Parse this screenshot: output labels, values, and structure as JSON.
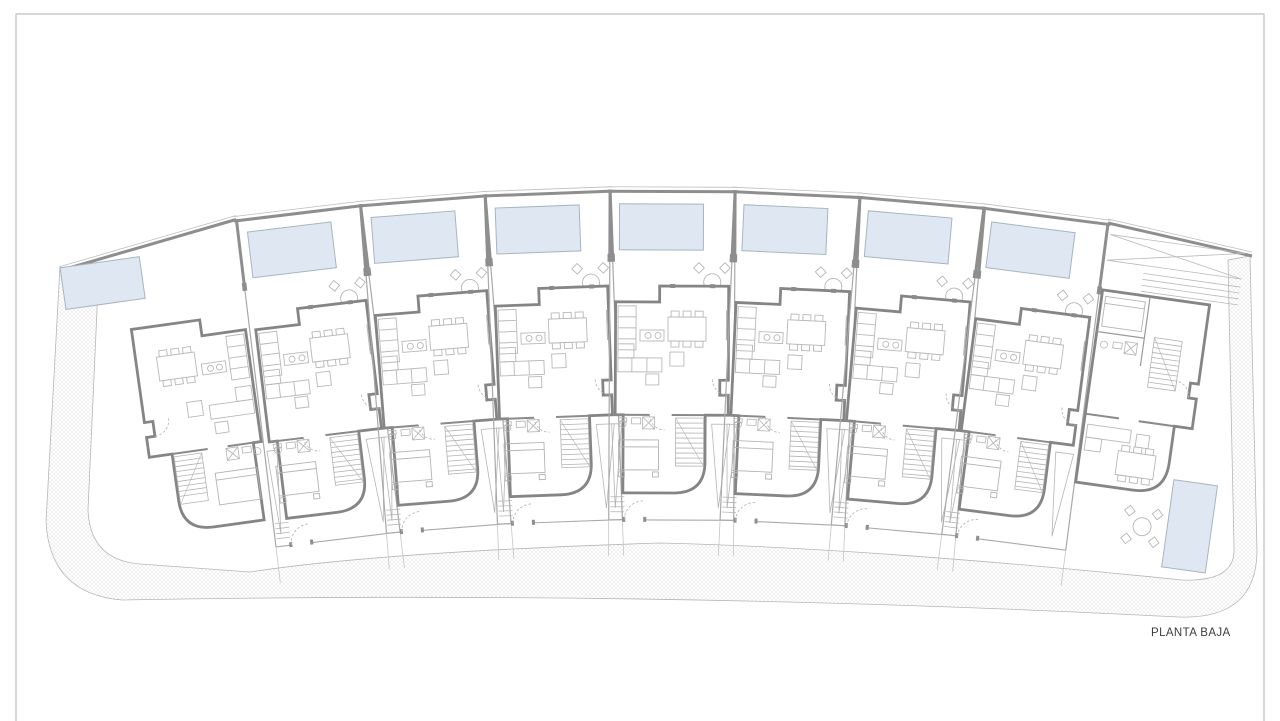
{
  "plan": {
    "title": "PLANTA BAJA",
    "type": "residential-site-plan-ground-floor",
    "units_total": 9,
    "standard_units": 7
  },
  "colors": {
    "paper": "#ffffff",
    "frame": "#bdbdbd",
    "boundary": "#b6b6b6",
    "wall_dark": "#858585",
    "wall_mid": "#9a9a9a",
    "line_light": "#b8b8b8",
    "hatch": "#dedede",
    "pool_fill": "#dfe8f2",
    "pool_border": "#a8b4c2",
    "label": "#3d3d3d"
  },
  "arc": {
    "cx": 660,
    "cy": 3200
  },
  "units": [
    {
      "id": "unit-1",
      "kind": "end-left"
    },
    {
      "id": "unit-2",
      "kind": "standard",
      "angle": -6.9
    },
    {
      "id": "unit-3",
      "kind": "standard",
      "angle": -4.52
    },
    {
      "id": "unit-4",
      "kind": "standard",
      "angle": -2.14
    },
    {
      "id": "unit-5",
      "kind": "standard",
      "angle": 0.24
    },
    {
      "id": "unit-6",
      "kind": "standard",
      "angle": 2.62
    },
    {
      "id": "unit-7",
      "kind": "standard",
      "angle": 5.0
    },
    {
      "id": "unit-8",
      "kind": "standard",
      "angle": 7.37
    },
    {
      "id": "unit-9",
      "kind": "end-right"
    }
  ]
}
